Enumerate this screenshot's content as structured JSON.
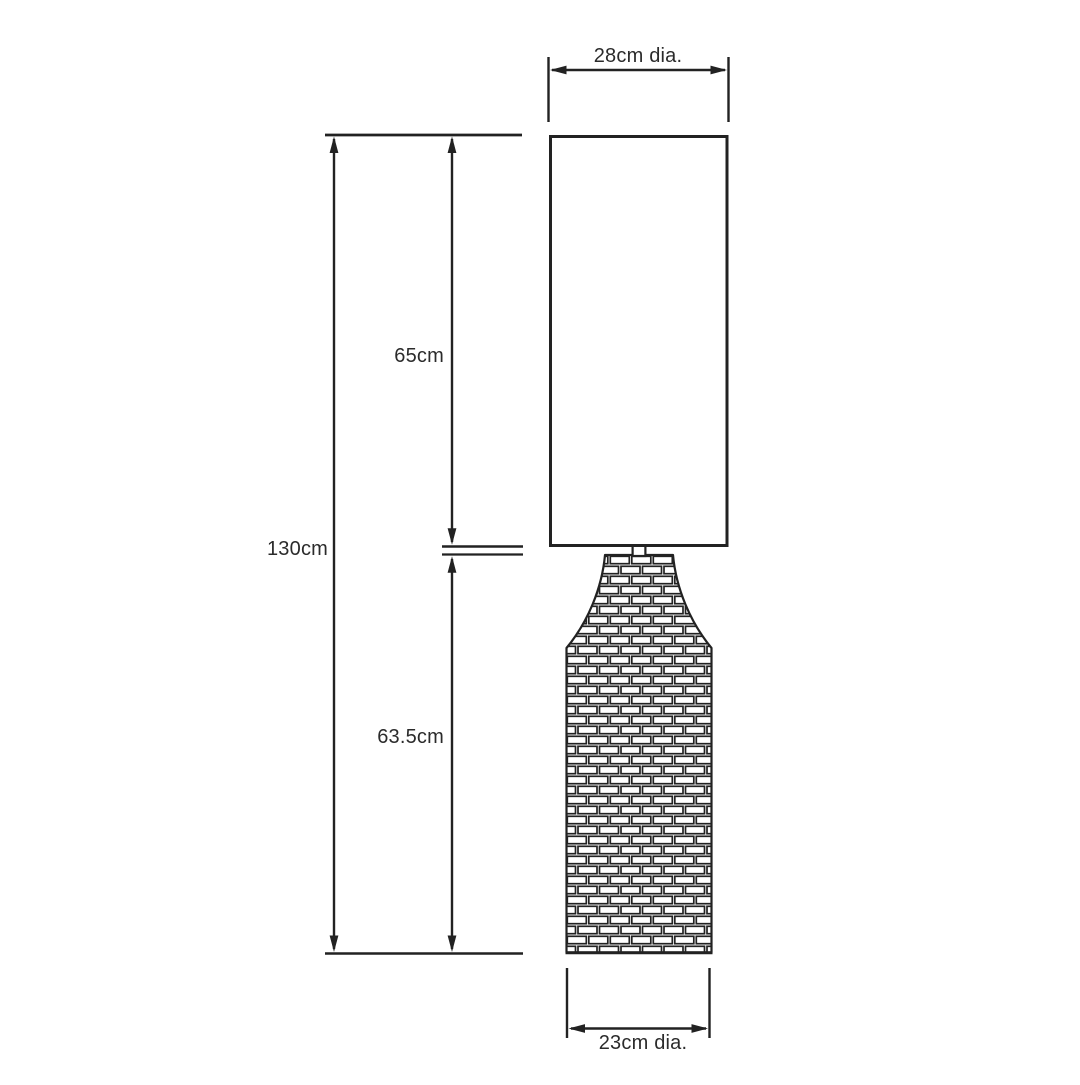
{
  "diagram": {
    "kind": "product-dimension-diagram",
    "subject": "floor lamp with cylindrical shade and brick-textured bottle-shaped base",
    "colors": {
      "line": "#222222",
      "text": "#2b2b2b",
      "background": "#ffffff"
    },
    "labels": {
      "shade_diameter": "28cm dia.",
      "shade_height": "65cm",
      "total_height": "130cm",
      "base_height": "63.5cm",
      "base_diameter": "23cm dia."
    },
    "values": {
      "unit": "cm",
      "shade_diameter": 28,
      "shade_height": 65,
      "total_height": 130,
      "base_height": 63.5,
      "base_diameter": 23
    }
  }
}
